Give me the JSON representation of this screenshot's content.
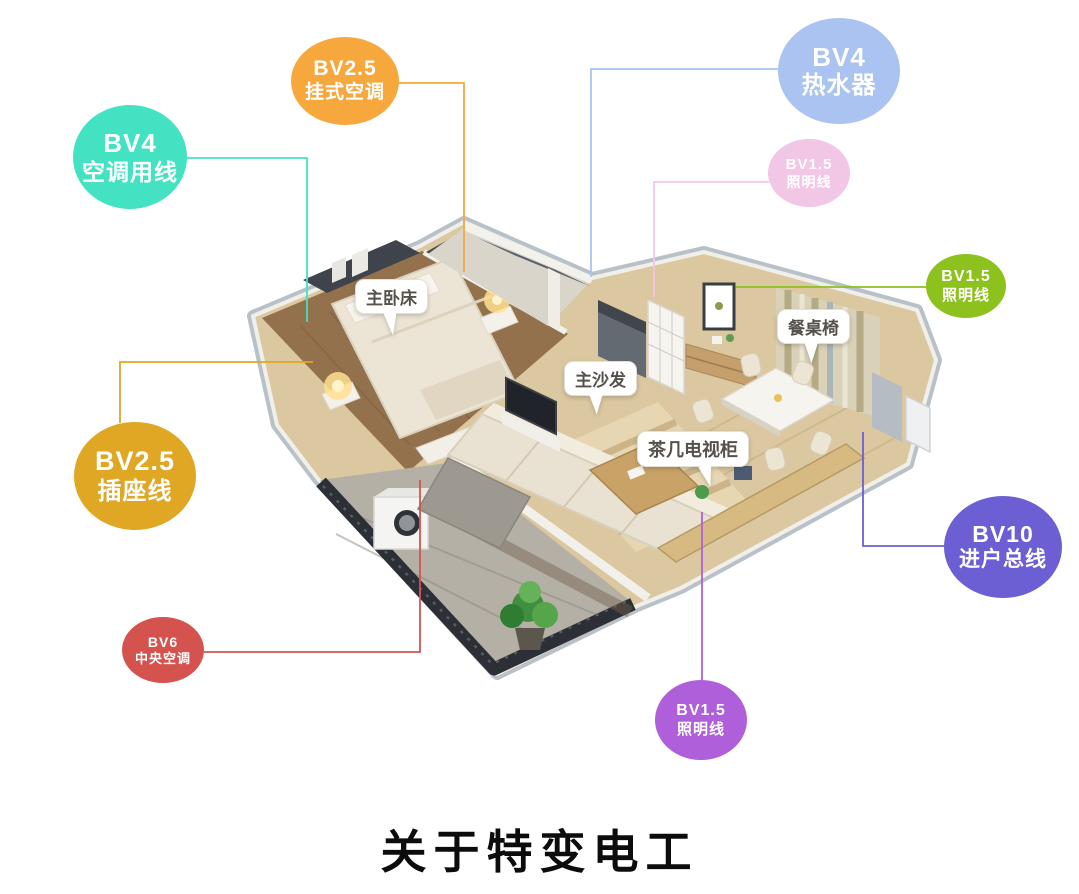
{
  "title": {
    "text": "关于特变电工"
  },
  "badges": [
    {
      "name": "ac-wire",
      "code": "BV4",
      "label": "空调用线",
      "color": "#42e2c2"
    },
    {
      "name": "wall-ac",
      "code": "BV2.5",
      "label": "挂式空调",
      "color": "#f7a83d"
    },
    {
      "name": "water-heater",
      "code": "BV4",
      "label": "热水器",
      "color": "#aac3f0"
    },
    {
      "name": "lighting-top",
      "code": "BV1.5",
      "label": "照明线",
      "color": "#f2c6e5"
    },
    {
      "name": "lighting-right",
      "code": "BV1.5",
      "label": "照明线",
      "color": "#8cc11e"
    },
    {
      "name": "main-entry-line",
      "code": "BV10",
      "label": "进户总线",
      "color": "#6c5fd4"
    },
    {
      "name": "socket-wire",
      "code": "BV2.5",
      "label": "插座线",
      "color": "#dfa724"
    },
    {
      "name": "central-ac",
      "code": "BV6",
      "label": "中央空调",
      "color": "#d5534e"
    },
    {
      "name": "lighting-bottom",
      "code": "BV1.5",
      "label": "照明线",
      "color": "#ae5fd9"
    }
  ],
  "callouts": [
    {
      "name": "master-bed",
      "label": "主卧床"
    },
    {
      "name": "main-sofa",
      "label": "主沙发"
    },
    {
      "name": "tea-table-tv-cabinet",
      "label": "茶几电视柜"
    },
    {
      "name": "dining-table-chairs",
      "label": "餐桌椅"
    }
  ]
}
